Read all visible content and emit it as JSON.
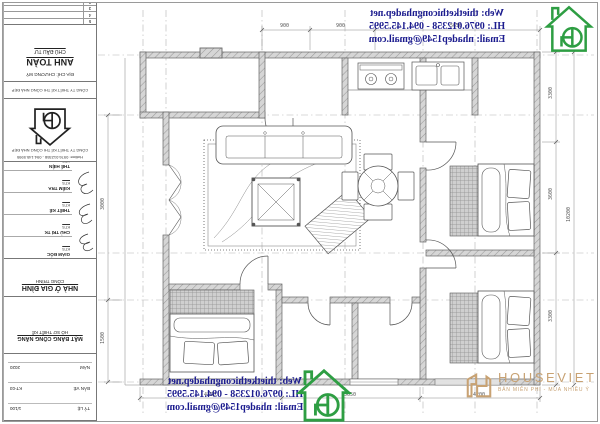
{
  "watermark": {
    "web": "Web: thietkethicongnhadep.net",
    "hotline": "HL: 0976.012358 - 094.145.5995",
    "email": "Email: nhadep1549@gmail.com"
  },
  "brand": {
    "name": "HOUSEVIET",
    "tagline": "BẢN MIỄN PHÍ - MUA NHIỀU Ý"
  },
  "colors": {
    "watermark_text": "#1b1b8e",
    "logo_green": "#2e9e43",
    "brand_tan": "#c8a273",
    "wall_gray": "#d6d6d6"
  },
  "title_block": {
    "revision_header": "NỘI DUNG SỬA ĐỔI",
    "revision_rows": [
      "1",
      "2",
      "3",
      "4",
      "5"
    ],
    "investor_label": "CHỦ ĐẦU TƯ",
    "investor_name": "ANH TOÀN",
    "investor_address": "ĐỊA CHỈ: CHƯƠNG MỸ",
    "company_bar": "CÔNG TY THIẾT KẾ THI CÔNG NHÀ ĐẸP",
    "logo_caption1": "CÔNG TY THIẾT KẾ THI CÔNG NHÀ ĐẸP",
    "logo_caption2": "Hotline: 0976.012358 - 094.145.5995",
    "signatures": [
      {
        "role": "GIÁM ĐỐC",
        "name": "KTS"
      },
      {
        "role": "CHỦ TRÌ TK",
        "name": "KTS"
      },
      {
        "role": "THIẾT KẾ",
        "name": "KTS"
      },
      {
        "role": "KIỂM TRA",
        "name": "KTS"
      },
      {
        "role": "THỂ HIỆN",
        "name": "KTS"
      }
    ],
    "category_label": "CÔNG TRÌNH",
    "project_name": "NHÀ Ở GIA ĐÌNH",
    "stage": "HỒ SƠ THIẾT KẾ",
    "drawing_name": "MẶT BẰNG CÔNG NĂNG",
    "fields": [
      {
        "label": "TỶ LỆ",
        "value": "1/100"
      },
      {
        "label": "BẢN VẼ",
        "value": "KT-03"
      },
      {
        "label": "NĂM",
        "value": "2020"
      }
    ]
  },
  "dims": {
    "top": [
      "900",
      "900",
      "5650"
    ],
    "right": [
      "3300",
      "3600",
      "3300"
    ],
    "right_total": "10200",
    "bottom": [
      "4350",
      "5650",
      "4200"
    ],
    "left": [
      "3000",
      "1500"
    ]
  }
}
